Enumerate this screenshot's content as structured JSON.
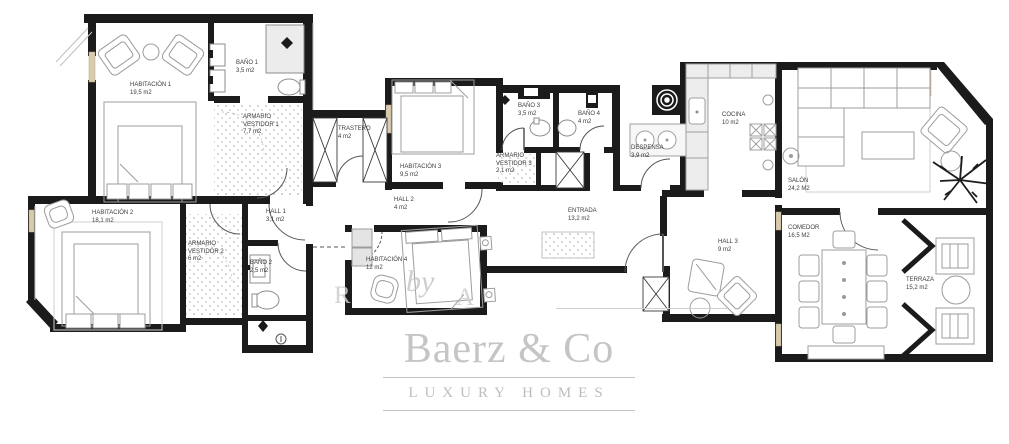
{
  "plan": {
    "rooms": [
      {
        "name": "HABITACIÓN 1",
        "area": "19,5 m2"
      },
      {
        "name": "BAÑO 1",
        "area": "3,5 m2"
      },
      {
        "name": "ARMARIO VESTIDOR 1",
        "area": "7,7 m2"
      },
      {
        "name": "TRASTERO",
        "area": "4 m2"
      },
      {
        "name": "HABITACIÓN 3",
        "area": "9,5 m2"
      },
      {
        "name": "BAÑO 3",
        "area": "3,5 m2"
      },
      {
        "name": "BAÑO 4",
        "area": "4 m2"
      },
      {
        "name": "ARMARIO VESTIDOR 3",
        "area": "2,1 m2"
      },
      {
        "name": "DESPENSA",
        "area": "3,9 m2"
      },
      {
        "name": "COCINA",
        "area": "10 m2"
      },
      {
        "name": "SALÓN",
        "area": "24,2 M2"
      },
      {
        "name": "HABITACIÓN 2",
        "area": "18,1 m2"
      },
      {
        "name": "ARMARIO VESTIDOR 2",
        "area": "6 m2"
      },
      {
        "name": "HALL 1",
        "area": "3,1 m2"
      },
      {
        "name": "BAÑO 2",
        "area": "2,5 m2"
      },
      {
        "name": "HALL 2",
        "area": "4 m2"
      },
      {
        "name": "HABITACIÓN 4",
        "area": "12 m2"
      },
      {
        "name": "ENTRADA",
        "area": "13,2 m2"
      },
      {
        "name": "HALL 3",
        "area": "9 m2"
      },
      {
        "name": "COMEDOR",
        "area": "16,5 M2"
      },
      {
        "name": "TERRAZA",
        "area": "15,2 m2"
      }
    ],
    "symbols": {
      "shower_head": "diamond",
      "extractor_fan": "concentric-circles",
      "drain_point": "circle-cross"
    }
  },
  "watermark": {
    "left_letter": "R",
    "by": "by",
    "right_letter": "A"
  },
  "logo": {
    "title": "Baerz & Co",
    "subtitle": "LUXURY HOMES"
  },
  "colors": {
    "wall": "#1b1b1b",
    "furniture_stroke": "#9c9c9c",
    "window": "#d9cbae",
    "label_text": "#3c3c3c",
    "logo_gray": "#c5c5c5"
  }
}
